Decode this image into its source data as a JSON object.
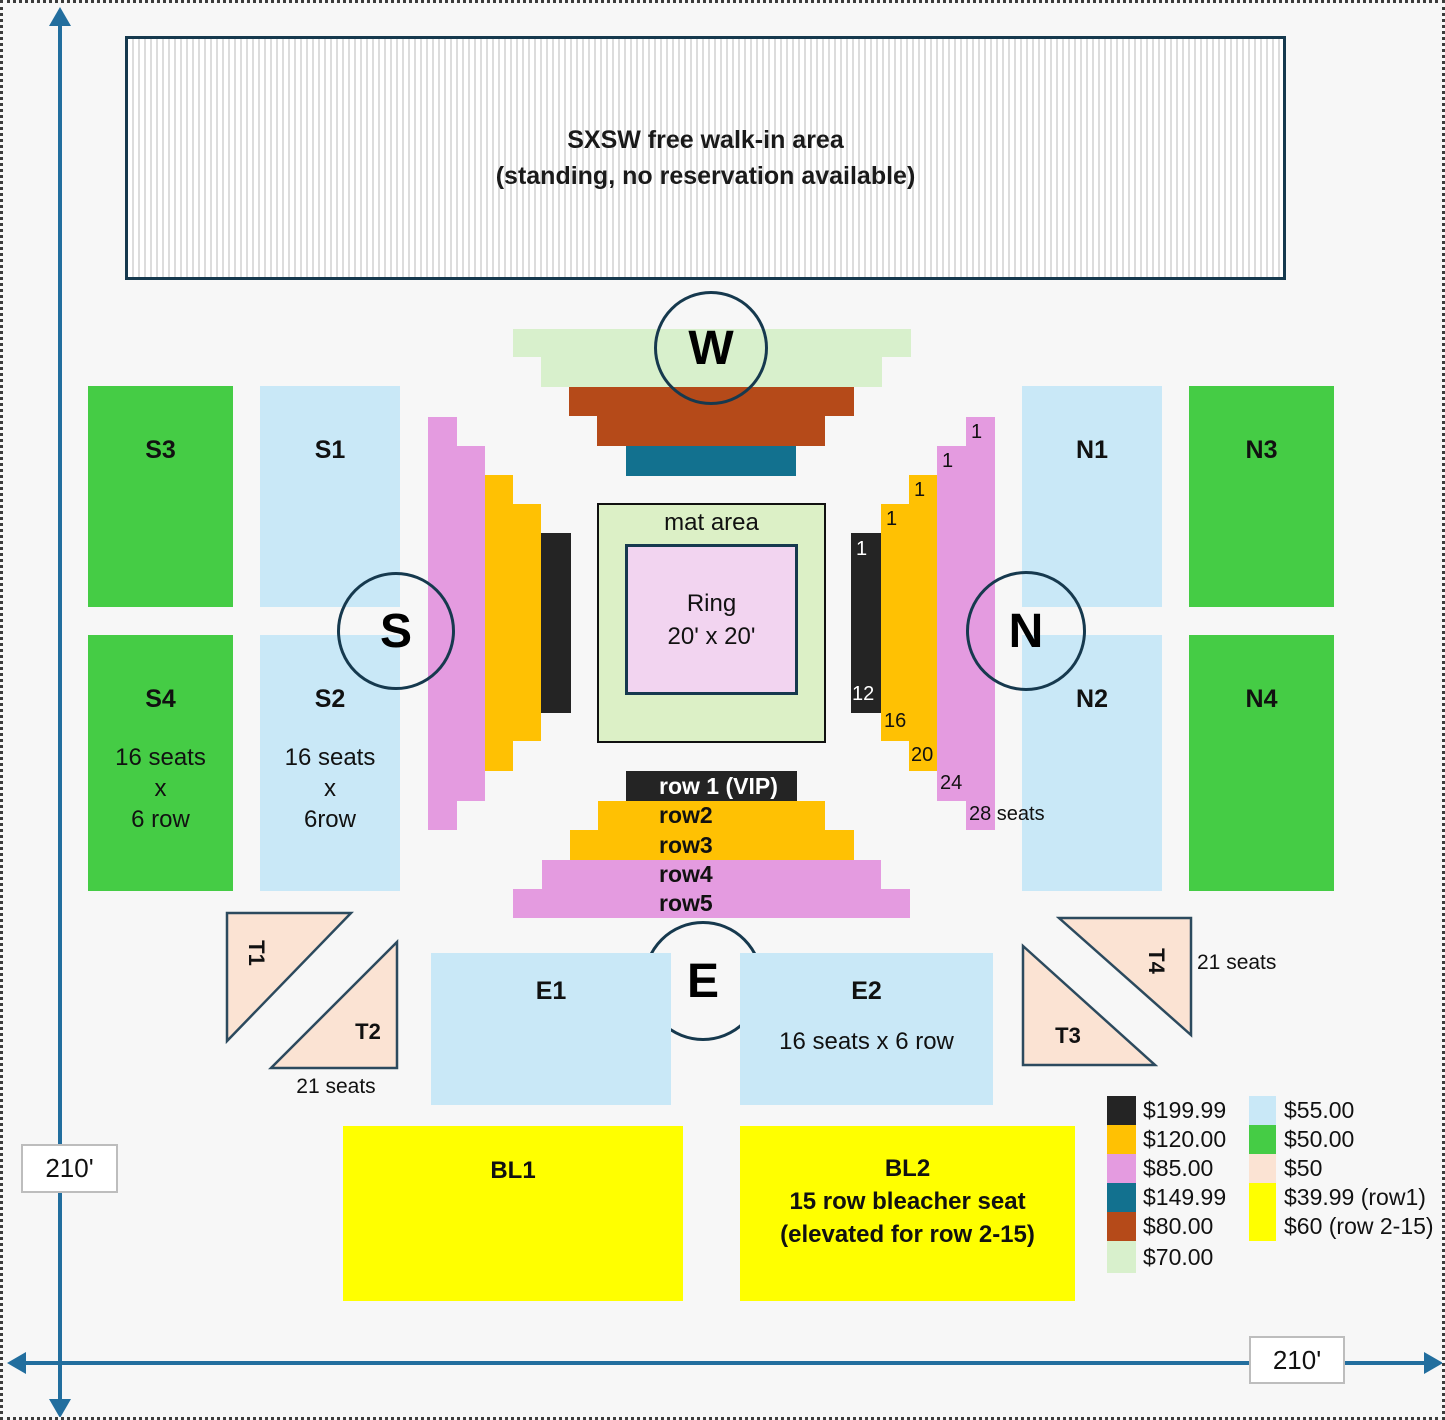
{
  "walkin": {
    "line1": "SXSW free walk-in area",
    "line2": "(standing, no reservation available)"
  },
  "dim": {
    "v_label": "210'",
    "h_label": "210'"
  },
  "compass": {
    "w": "W",
    "s": "S",
    "n": "N",
    "e": "E"
  },
  "matring": {
    "mat_label": "mat area",
    "ring_line1": "Ring",
    "ring_line2": "20' x 20'"
  },
  "sections": {
    "s3": "S3",
    "s1": "S1",
    "s4": "S4",
    "s2": "S2",
    "n1": "N1",
    "n3": "N3",
    "n2": "N2",
    "n4": "N4",
    "s4_detail": [
      "16 seats",
      "x",
      "6 row"
    ],
    "s2_detail": [
      "16 seats",
      "x",
      "6row"
    ],
    "e1": "E1",
    "e2": "E2",
    "e2_detail": "16 seats x 6 row",
    "bl1": "BL1",
    "bl2_line1": "BL2",
    "bl2_line2": "15 row bleacher seat",
    "bl2_line3": "(elevated for row 2-15)"
  },
  "east_rows": {
    "row1": "row 1 (VIP)",
    "row2": "row2",
    "row3": "row3",
    "row4": "row4",
    "row5": "row5"
  },
  "north_row_numbers": {
    "r1_first": "1",
    "r1_last": "12",
    "r2_first": "1",
    "r2_last": "16",
    "r3_first": "1",
    "r3_last": "20",
    "r4_first": "1",
    "r4_last": "24",
    "r5_first": "1",
    "r5_last": "28 seats"
  },
  "triangles": {
    "t1": "T1",
    "t2": "T2",
    "t3": "T3",
    "t4": "T4",
    "t2_seats": "21 seats",
    "t4_seats": "21 seats"
  },
  "legend": {
    "left": [
      {
        "color": "#242424",
        "label": "$199.99"
      },
      {
        "color": "#FFC103",
        "label": "$120.00"
      },
      {
        "color": "#E49BE0",
        "label": "$85.00"
      },
      {
        "color": "#12718F",
        "label": "$149.99"
      },
      {
        "color": "#B54A19",
        "label": "$80.00"
      },
      {
        "color": "#D8F0CC",
        "label": "$70.00"
      }
    ],
    "right": [
      {
        "color": "#C9E8F7",
        "label": "$55.00"
      },
      {
        "color": "#45CC45",
        "label": "$50.00"
      },
      {
        "color": "#FBE3D3",
        "label": "$50"
      },
      {
        "color": "#FFFF00",
        "label": "$39.99 (row1)",
        "label2": "$60 (row 2-15)"
      }
    ]
  },
  "colors": {
    "background": "#F7F7F7",
    "navy_border": "#16394E",
    "arrow_blue": "#226E9E",
    "green_section": "#45CC45",
    "blue_section": "#C9E8F7",
    "pink_row": "#E49BE0",
    "orange_row": "#FFC103",
    "black_row": "#242424",
    "teal_row": "#12718F",
    "brown_row": "#B54A19",
    "light_green": "#D8F0CC",
    "mat_green": "#DCF0C6",
    "ring_pink": "#F2D4F0",
    "peach_triangle": "#FBE3D3",
    "yellow_bleacher": "#FFFF00"
  }
}
